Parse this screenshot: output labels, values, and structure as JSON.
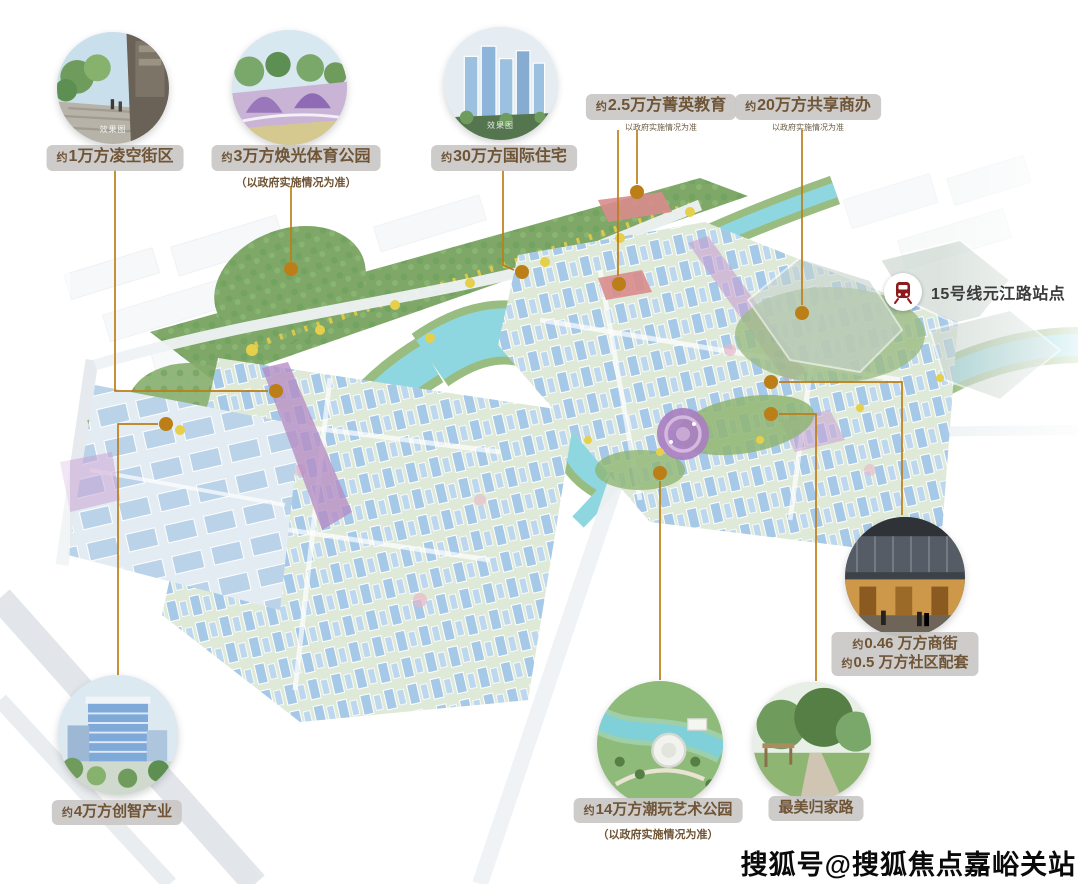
{
  "callouts": {
    "lingkong": {
      "prefix": "约",
      "text": "1万方凌空街区"
    },
    "sports": {
      "prefix": "约",
      "text": "3万方焕光体育公园",
      "note": "（以政府实施情况为准）"
    },
    "residence": {
      "prefix": "约",
      "text": "30万方国际住宅"
    },
    "education": {
      "prefix": "约",
      "text": "2.5万方菁英教育",
      "note": "以政府实施情况为准"
    },
    "office": {
      "prefix": "约",
      "text": "20万方共享商办",
      "note": "以政府实施情况为准"
    },
    "metro": {
      "text": "15号线元江路站点"
    },
    "street": {
      "line1_prefix": "约",
      "line1": "0.46 万方商街",
      "line2_prefix": "约",
      "line2": "0.5 万方社区配套"
    },
    "artpark": {
      "prefix": "约",
      "text": "14万方潮玩艺术公园",
      "note": "（以政府实施情况为准）"
    },
    "homecoming": {
      "text": "最美归家路"
    },
    "industry": {
      "prefix": "约",
      "text": "4万方创智产业"
    }
  },
  "photo_captions": {
    "lingkong": "效果图",
    "residence": "效果图"
  },
  "watermark": "搜狐号@搜狐焦点嘉峪关站",
  "colors": {
    "connector": "#BC7E17",
    "pill_text": "#6F5436",
    "pill_bg": "#C9C8C5",
    "metro_icon_red": "#8E1B1B",
    "water": "#8ED7E0",
    "elevated_street_purple": "#B58CC4",
    "school_plot_red": "#D98C8C"
  }
}
